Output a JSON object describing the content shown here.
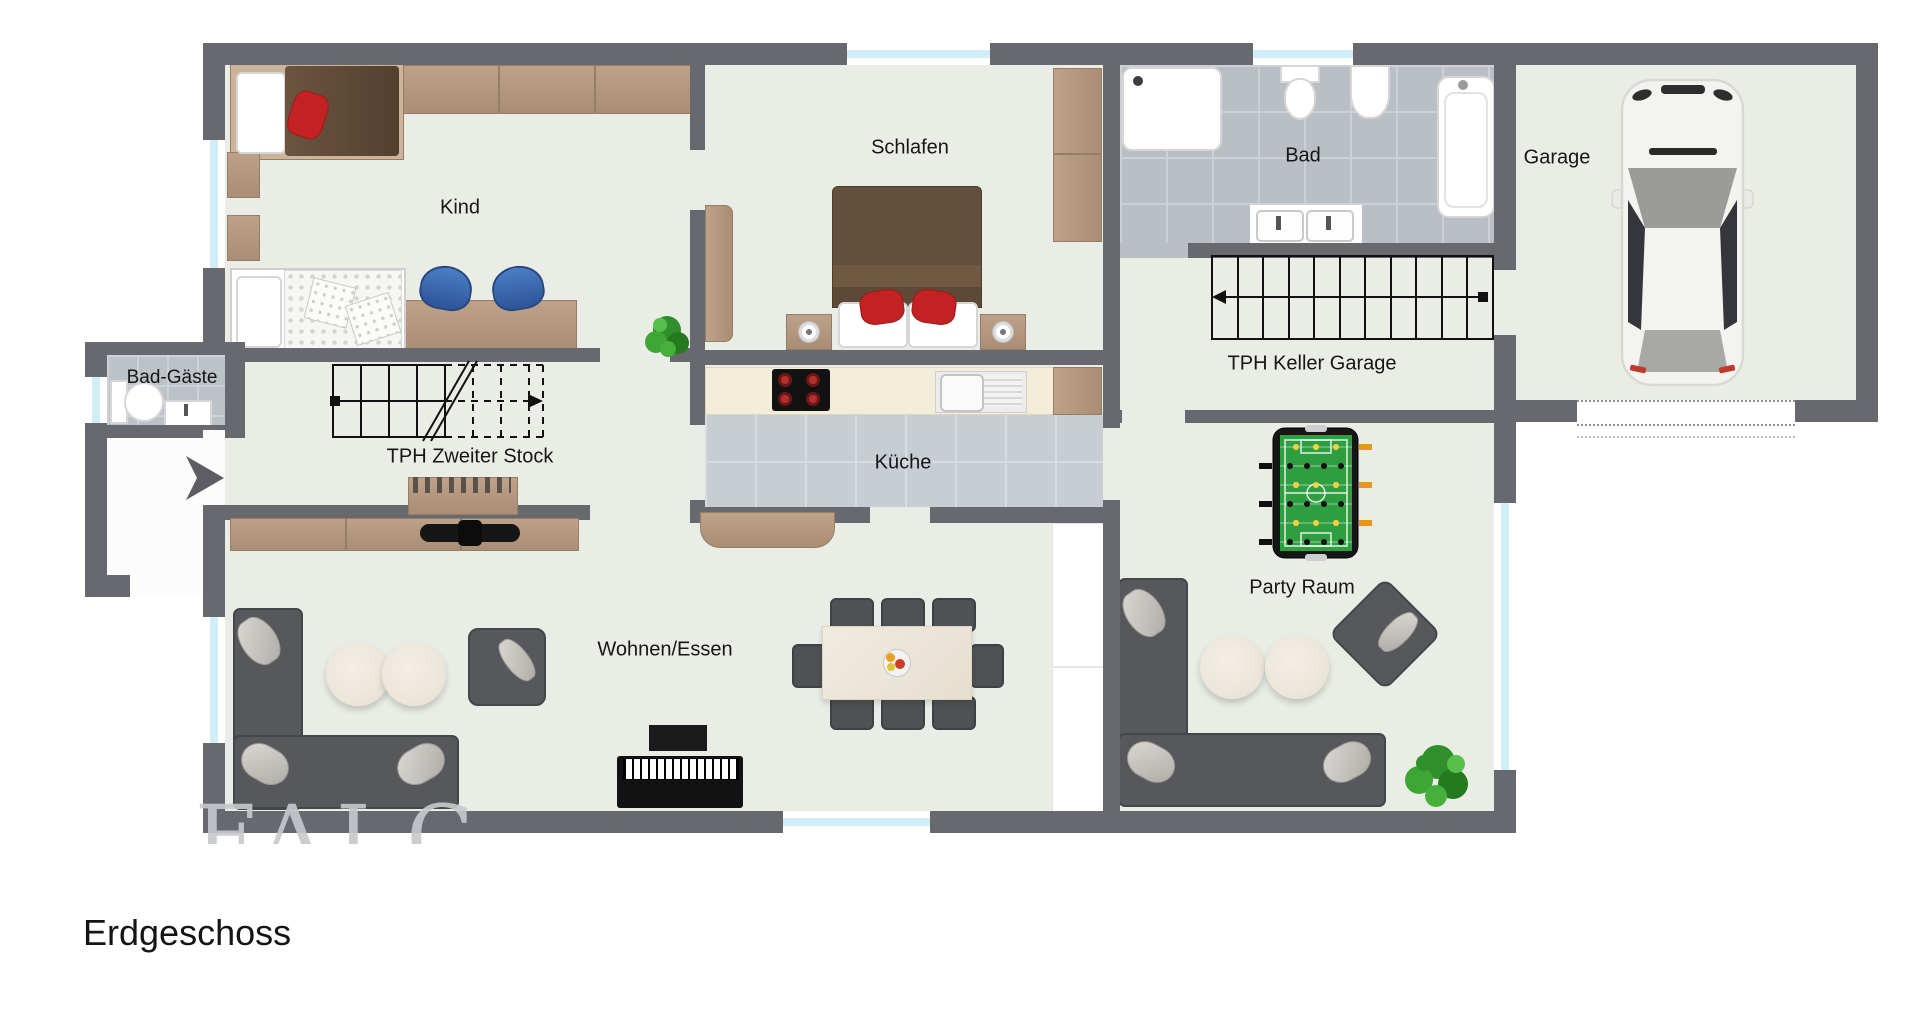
{
  "title": "Erdgeschoss",
  "watermark": "FALC",
  "rooms": {
    "kind": {
      "label": "Kind",
      "furniture": [
        "single-bed",
        "second-bed",
        "wardrobe",
        "wall-shelves",
        "desk",
        "two-desk-chairs"
      ]
    },
    "bad_gaeste": {
      "label": "Bad-Gäste",
      "furniture": [
        "toilet",
        "washbasin"
      ]
    },
    "schlafen": {
      "label": "Schlafen",
      "furniture": [
        "double-bed",
        "two-nightstands",
        "wardrobe",
        "dresser"
      ]
    },
    "kueche": {
      "label": "Küche",
      "furniture": [
        "countertop",
        "cooktop",
        "sink",
        "bench"
      ]
    },
    "bad": {
      "label": "Bad",
      "furniture": [
        "shower",
        "toilet",
        "bidet",
        "bathtub",
        "double-washbasin"
      ]
    },
    "garage": {
      "label": "Garage",
      "furniture": [
        "car"
      ]
    },
    "party_raum": {
      "label": "Party Raum",
      "furniture": [
        "foosball-table",
        "corner-sofa",
        "two-coffee-tables",
        "armchair",
        "plant"
      ]
    },
    "wohnen_essen": {
      "label": "Wohnen/Essen",
      "furniture": [
        "sideboard",
        "tv-soundbar",
        "corner-sofa",
        "two-coffee-tables",
        "armchair",
        "piano",
        "piano-bench",
        "dining-table",
        "eight-chairs",
        "fruit-bowl",
        "tall-cabinet"
      ]
    },
    "stairs_upper": {
      "label": "TPH Zweiter Stock"
    },
    "stairs_lower": {
      "label": "TPH Keller Garage"
    }
  },
  "icons": {
    "entry_arrow": "right-arrow",
    "plant": "potted-plant",
    "car": "car-top-view"
  },
  "colors": {
    "wall": "#68686f",
    "floor": "#eaede6",
    "bath_tile": "#b9bfc5",
    "kitchen_tile": "#c7cdd3",
    "wood": "#b2977e",
    "sofa": "#57585b",
    "blanket_brown": "#5e4937",
    "cushion_red": "#c32222",
    "chair_blue": "#3b66ad",
    "foosball_green": "#2f9e41",
    "window_glass": "#cfeef5",
    "stair_line": "#111111",
    "watermark_gray": "#c6c9cd"
  }
}
